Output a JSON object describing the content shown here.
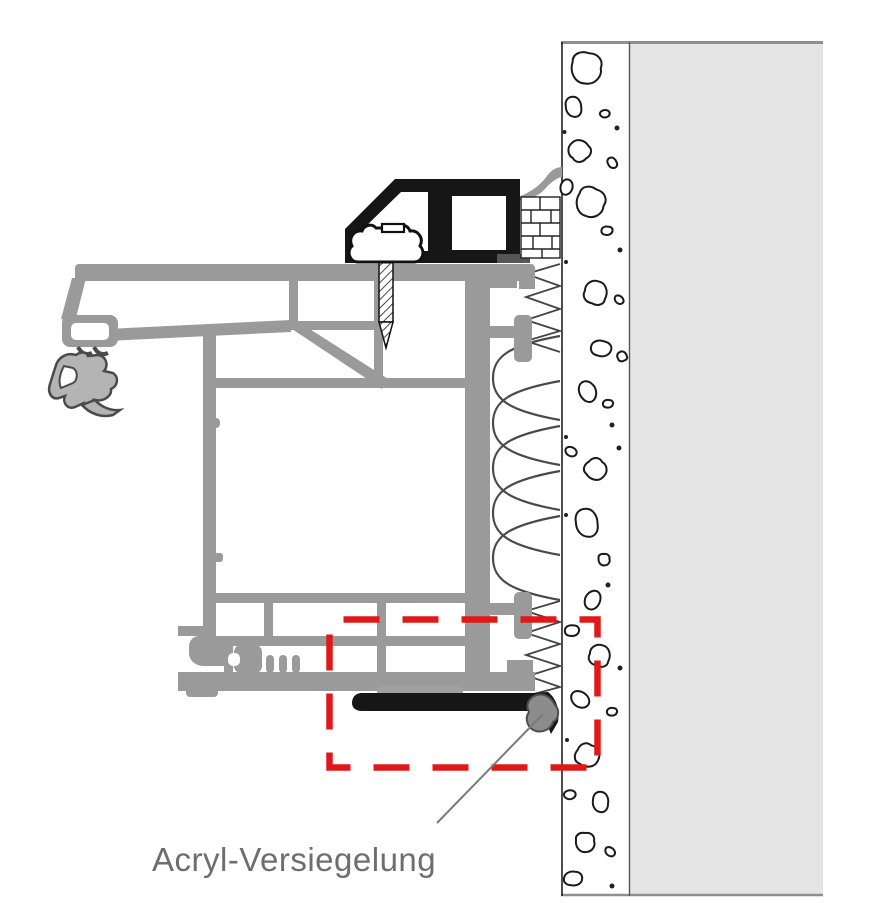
{
  "diagram": {
    "label": "Acryl-Versiegelung"
  },
  "colors": {
    "accent-red": "#e01818",
    "profile-gray": "#9a9a9a",
    "profile-dark": "#4a4a4a",
    "wall-gray": "#e4e4e4",
    "seal-black": "#161616",
    "text-gray": "#6e6e6e",
    "line-dark": "#1a1a1a"
  }
}
